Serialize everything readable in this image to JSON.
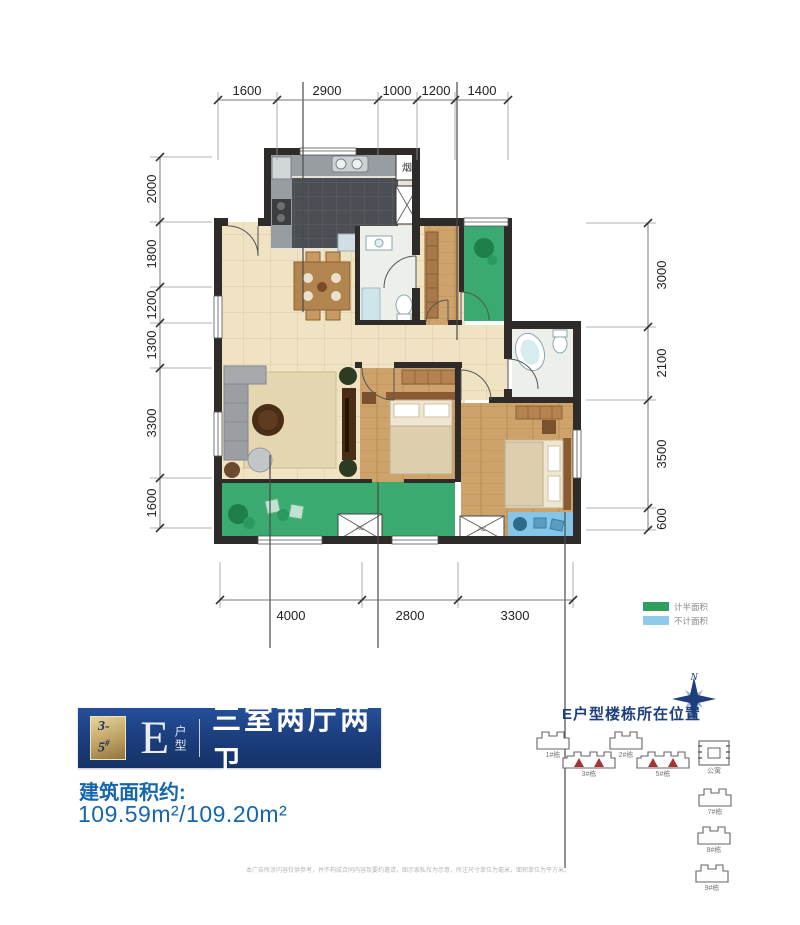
{
  "plan": {
    "dims": {
      "top": [
        "1600",
        "2900",
        "1000",
        "1200",
        "1400"
      ],
      "left": [
        "2000",
        "1800",
        "1200",
        "1300",
        "3300",
        "1600"
      ],
      "right": [
        "3000",
        "2100",
        "3500",
        "600"
      ],
      "bottom": [
        "4000",
        "2800",
        "3300"
      ]
    },
    "labels": {
      "flue": "烟",
      "ac": "AC"
    },
    "legend": [
      {
        "label": "计半面积",
        "color": "#2f9e5f"
      },
      {
        "label": "不计面积",
        "color": "#8fcbe8"
      }
    ]
  },
  "title_block": {
    "badge_number": "3-5",
    "badge_sup": "#",
    "unit_letter": "E",
    "unit_label": "户型",
    "unit_name": "三室两厅两卫",
    "area_caption": "建筑面积约:",
    "area_value": "109.59m²/109.20m²"
  },
  "location_map": {
    "title": "E户型楼栋所在位置",
    "compass_label": "N",
    "buildings": [
      {
        "label": "1#栋",
        "highlighted": false
      },
      {
        "label": "2#栋",
        "highlighted": false
      },
      {
        "label": "3#栋",
        "highlighted": true
      },
      {
        "label": "5#栋",
        "highlighted": true
      },
      {
        "label": "公寓",
        "highlighted": false
      },
      {
        "label": "7#栋",
        "highlighted": false
      },
      {
        "label": "8#栋",
        "highlighted": false
      },
      {
        "label": "9#栋",
        "highlighted": false
      }
    ]
  },
  "disclaimer": "本广告所涉内容仅供参考，并不构成合同内容及要约邀请，图示家私仅为示意，所注尺寸单位为毫米，面积单位为平方米。",
  "colors": {
    "banner_blue": "#1a3c7a",
    "accent_blue": "#1466ad",
    "badge_gold": "#bb9d5f",
    "wall": "#2e2b28",
    "tile_floor": "#f0e3c3",
    "wood_floor": "#cda36b",
    "balcony_green": "#3aaa71",
    "balcony_blue": "#85c6e8",
    "highlight_red": "#a33430",
    "compass_blue": "#1e3f7c"
  }
}
